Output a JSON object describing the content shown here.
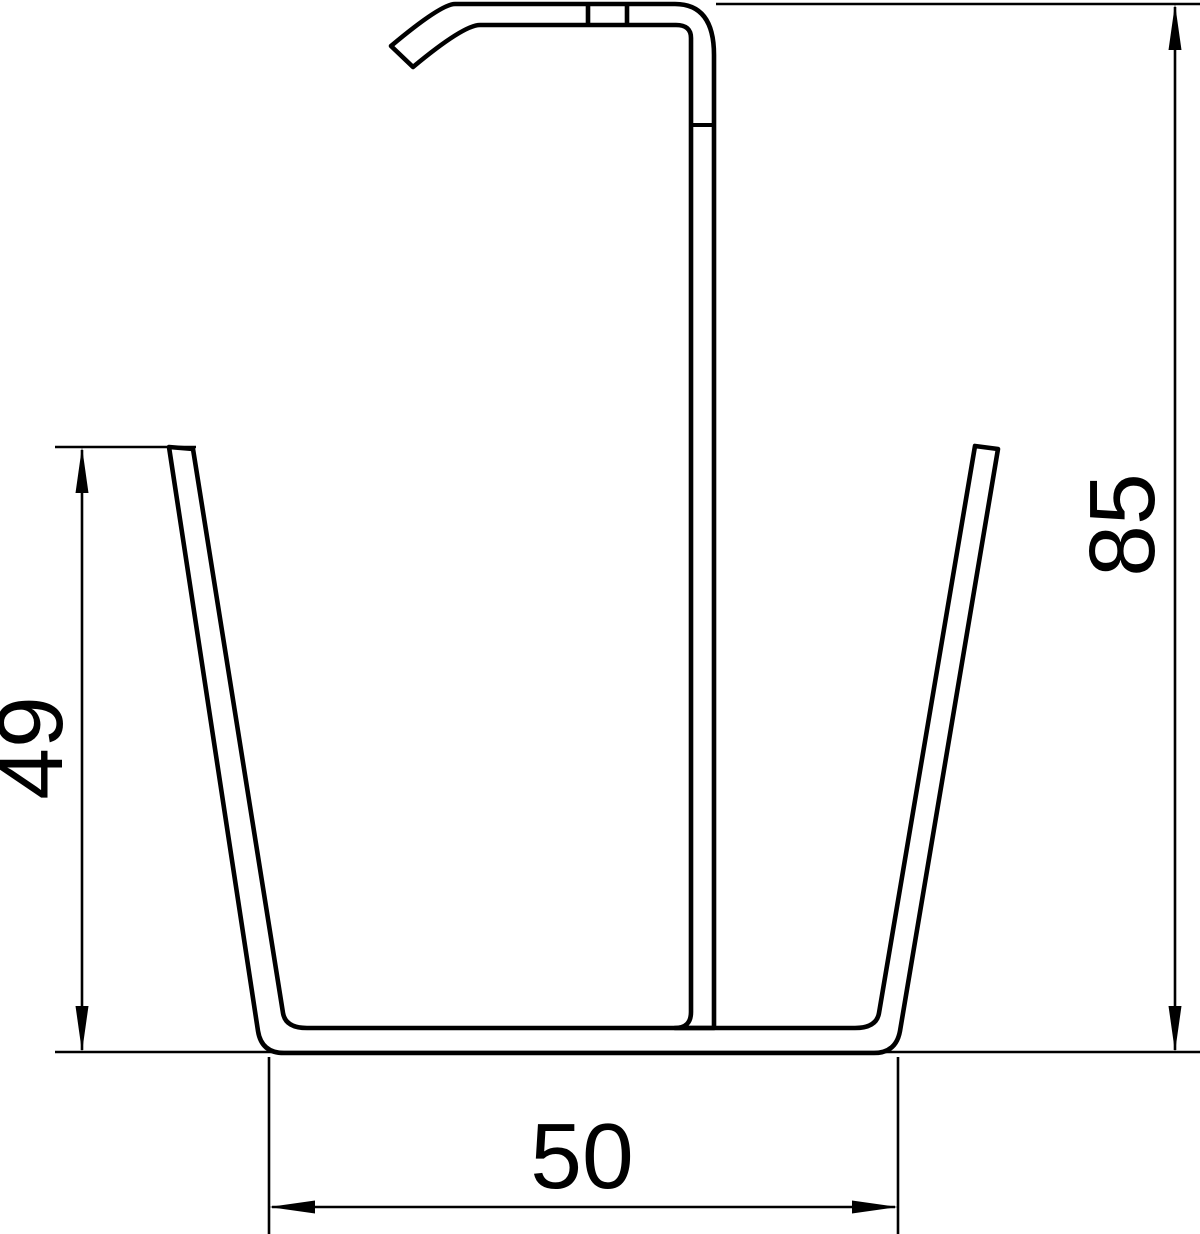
{
  "drawing": {
    "background_color": "#ffffff",
    "line_color": "#000000",
    "type": "technical-cross-section-profile",
    "labels": {
      "left_height": "49",
      "right_height": "85",
      "bottom_width": "50"
    }
  }
}
